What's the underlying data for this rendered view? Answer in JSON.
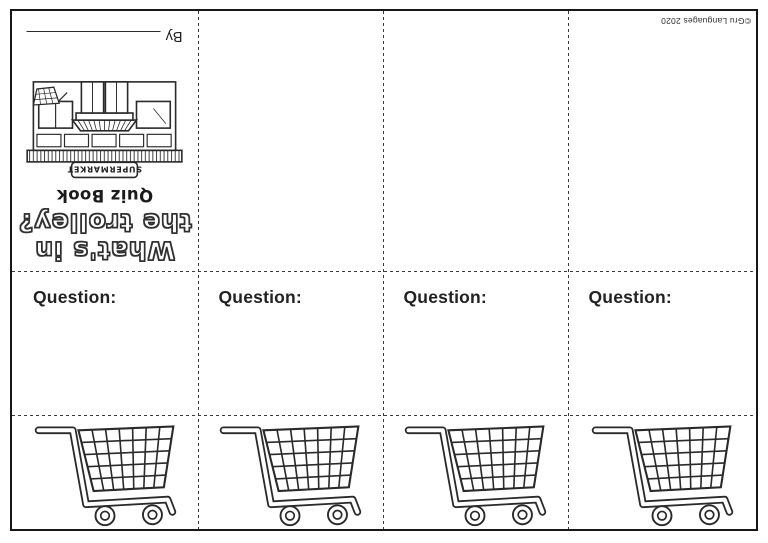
{
  "cover": {
    "title_line1": "What's in",
    "title_line2": "the trolley?",
    "subtitle": "Quiz Book",
    "storefront_sign_text": "SUPERMARKET",
    "byline_label": "By"
  },
  "copyright_text": "©Gru Languages 2020",
  "question_cells": [
    {
      "label": "Question:"
    },
    {
      "label": "Question:"
    },
    {
      "label": "Question:"
    },
    {
      "label": "Question:"
    }
  ],
  "icons": {
    "trolley": "shopping-trolley-line-art",
    "storefront": "supermarket-storefront-line-art"
  },
  "colors": {
    "ink": "#2a2a2a",
    "paper": "#ffffff",
    "fold_line": "#3a3a3a"
  }
}
